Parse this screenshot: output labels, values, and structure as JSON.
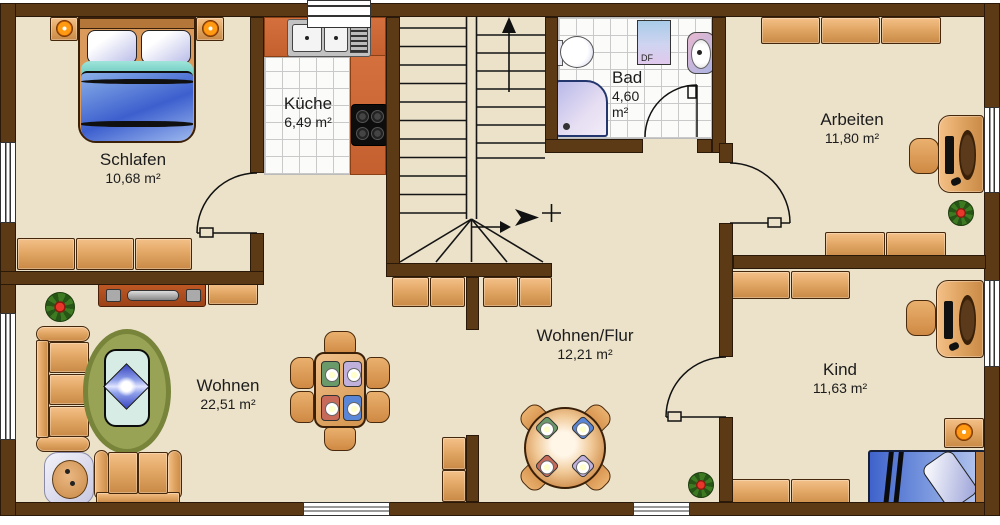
{
  "title": "Grundriss Obergeschoss",
  "rooms": [
    {
      "name": "Schlafen",
      "area": "10,68 m²"
    },
    {
      "name": "Küche",
      "area": "6,49 m²"
    },
    {
      "name": "Bad",
      "area": "4,60 m²"
    },
    {
      "name": "Arbeiten",
      "area": "11,80 m²"
    },
    {
      "name": "Wohnen",
      "area": "22,51 m²"
    },
    {
      "name": "Wohnen/Flur",
      "area": "12,21 m²"
    },
    {
      "name": "Kind",
      "area": "11,63 m²"
    }
  ],
  "annotations": {
    "roof_window_label": "DF"
  },
  "colors": {
    "wall": "#5d3a16",
    "floor": "#ece2ca",
    "kitchen_counter": "#c4602f",
    "furniture_tan": "#e2a765",
    "rug_green": "#98a355",
    "bed_blue": "#4f6fd8",
    "accent_lamp": "#ff9a12"
  }
}
